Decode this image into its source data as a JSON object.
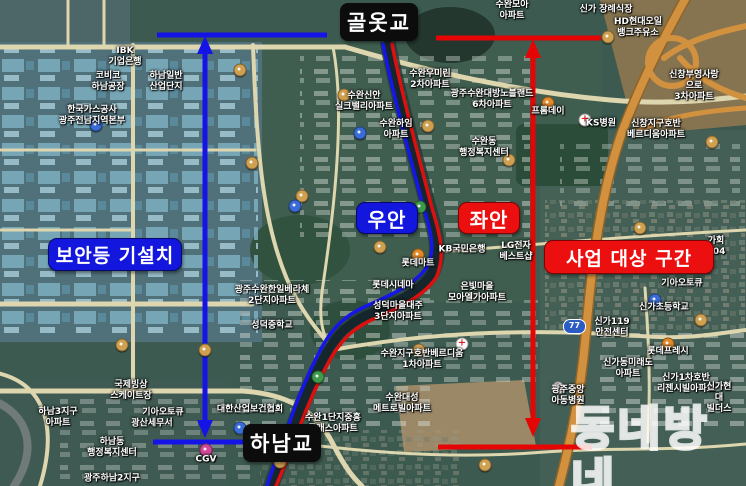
{
  "annotations": {
    "top_bridge": "골옷교",
    "bottom_bridge": "하남교",
    "security_light_installed": "보안등 기설치",
    "right_bank": "우안",
    "left_bank": "좌안",
    "project_section": "사업 대상 구간"
  },
  "watermark": "동네방네",
  "route_shield": "77",
  "colors": {
    "bracket_blue": "#1414e6",
    "bracket_red": "#e60505",
    "route_blue": "#1616e8",
    "route_red": "#dd0f0f",
    "black_label_bg": "#0c0c0c",
    "label_text": "#ffffff"
  },
  "map_labels": [
    {
      "text": "IBK\n기업은행",
      "x": 125,
      "y": 57
    },
    {
      "text": "코비코\n하남공장",
      "x": 108,
      "y": 82
    },
    {
      "text": "하남일반\n산업단지",
      "x": 166,
      "y": 82
    },
    {
      "text": "한국가스공사\n광주전남지역본부",
      "x": 92,
      "y": 116
    },
    {
      "text": "수완모아\n아파트",
      "x": 512,
      "y": 11
    },
    {
      "text": "신가 장례식장",
      "x": 606,
      "y": 10
    },
    {
      "text": "HD현대오일\n뱅크주유소",
      "x": 638,
      "y": 28
    },
    {
      "text": "신창부영사랑으로\n3차아파트",
      "x": 694,
      "y": 86
    },
    {
      "text": "신창지구호반\n베르디움아파트",
      "x": 656,
      "y": 130
    },
    {
      "text": "KS병원",
      "x": 601,
      "y": 124
    },
    {
      "text": "광주수완대방노블랜드\n6차아파트",
      "x": 492,
      "y": 100
    },
    {
      "text": "수완우미린\n2차아파트",
      "x": 430,
      "y": 80
    },
    {
      "text": "수완신안\n실크밸리아파트",
      "x": 364,
      "y": 102
    },
    {
      "text": "수완하임\n아파트",
      "x": 396,
      "y": 130
    },
    {
      "text": "수완동\n행정복지센터",
      "x": 484,
      "y": 148
    },
    {
      "text": "프롬데이",
      "x": 548,
      "y": 112
    },
    {
      "text": "가회304",
      "x": 716,
      "y": 247
    },
    {
      "text": "KB국민은행",
      "x": 462,
      "y": 250
    },
    {
      "text": "LG전자\n베스트샵",
      "x": 516,
      "y": 252
    },
    {
      "text": "롯데마트",
      "x": 418,
      "y": 264
    },
    {
      "text": "은빛마을\n모아엘가아파트",
      "x": 477,
      "y": 293
    },
    {
      "text": "기아오토큐",
      "x": 682,
      "y": 284
    },
    {
      "text": "신가초등학교",
      "x": 664,
      "y": 308
    },
    {
      "text": "신가119\n안전센터",
      "x": 612,
      "y": 328
    },
    {
      "text": "롯데프레시",
      "x": 668,
      "y": 352
    },
    {
      "text": "신가동미래도\n아파트",
      "x": 628,
      "y": 369
    },
    {
      "text": "신가1차호반\n리젠시빌아파트",
      "x": 686,
      "y": 384
    },
    {
      "text": "신가현대\n빌더스",
      "x": 719,
      "y": 398
    },
    {
      "text": "광주중앙\n아동병원",
      "x": 568,
      "y": 396
    },
    {
      "text": "롯데시네마",
      "x": 393,
      "y": 286
    },
    {
      "text": "광주수완한일베라체\n2단지아파트",
      "x": 272,
      "y": 296
    },
    {
      "text": "성덕마을대주\n3단지아파트",
      "x": 398,
      "y": 312
    },
    {
      "text": "성덕중학교",
      "x": 272,
      "y": 326
    },
    {
      "text": "수완지구호반베르디움\n1차아파트",
      "x": 422,
      "y": 360
    },
    {
      "text": "수완대성\n메트로빌아파트",
      "x": 402,
      "y": 404
    },
    {
      "text": "수완1단지중흥\n클래스아파트",
      "x": 333,
      "y": 424
    },
    {
      "text": "대한산업보건협회",
      "x": 250,
      "y": 410
    },
    {
      "text": "기아오토큐",
      "x": 163,
      "y": 413
    },
    {
      "text": "국제빙상\n스케이트장",
      "x": 131,
      "y": 391
    },
    {
      "text": "광산세무서",
      "x": 152,
      "y": 424
    },
    {
      "text": "하남동\n행정복지센터",
      "x": 112,
      "y": 448
    },
    {
      "text": "광주하남2지구",
      "x": 112,
      "y": 479
    },
    {
      "text": "CGV",
      "x": 206,
      "y": 460
    },
    {
      "text": "하남3지구\n아파트",
      "x": 58,
      "y": 418
    }
  ],
  "map_pois": [
    {
      "type": "fuel",
      "x": 240,
      "y": 70
    },
    {
      "type": "fuel",
      "x": 344,
      "y": 95
    },
    {
      "type": "fuel",
      "x": 302,
      "y": 196
    },
    {
      "type": "fuel",
      "x": 252,
      "y": 163
    },
    {
      "type": "fuel",
      "x": 428,
      "y": 126
    },
    {
      "type": "fuel",
      "x": 380,
      "y": 247
    },
    {
      "type": "fuel",
      "x": 509,
      "y": 160
    },
    {
      "type": "fuel",
      "x": 608,
      "y": 37
    },
    {
      "type": "fuel",
      "x": 712,
      "y": 142
    },
    {
      "type": "fuel",
      "x": 205,
      "y": 350
    },
    {
      "type": "fuel",
      "x": 122,
      "y": 345
    },
    {
      "type": "fuel",
      "x": 280,
      "y": 462
    },
    {
      "type": "fuel",
      "x": 485,
      "y": 465
    },
    {
      "type": "fuel",
      "x": 701,
      "y": 320
    },
    {
      "type": "fuel",
      "x": 640,
      "y": 228
    },
    {
      "type": "fuel",
      "x": 419,
      "y": 350
    },
    {
      "type": "store",
      "x": 668,
      "y": 344
    },
    {
      "type": "store",
      "x": 548,
      "y": 103
    },
    {
      "type": "store",
      "x": 418,
      "y": 255
    },
    {
      "type": "school",
      "x": 295,
      "y": 206
    },
    {
      "type": "school",
      "x": 655,
      "y": 300
    },
    {
      "type": "school",
      "x": 360,
      "y": 133
    },
    {
      "type": "school",
      "x": 96,
      "y": 125
    },
    {
      "type": "school",
      "x": 240,
      "y": 428
    },
    {
      "type": "hospital",
      "x": 585,
      "y": 120
    },
    {
      "type": "hospital",
      "x": 462,
      "y": 344
    },
    {
      "type": "hospital",
      "x": 558,
      "y": 388
    },
    {
      "type": "park",
      "x": 420,
      "y": 207
    },
    {
      "type": "park",
      "x": 318,
      "y": 377
    },
    {
      "type": "cinema",
      "x": 206,
      "y": 450
    }
  ]
}
